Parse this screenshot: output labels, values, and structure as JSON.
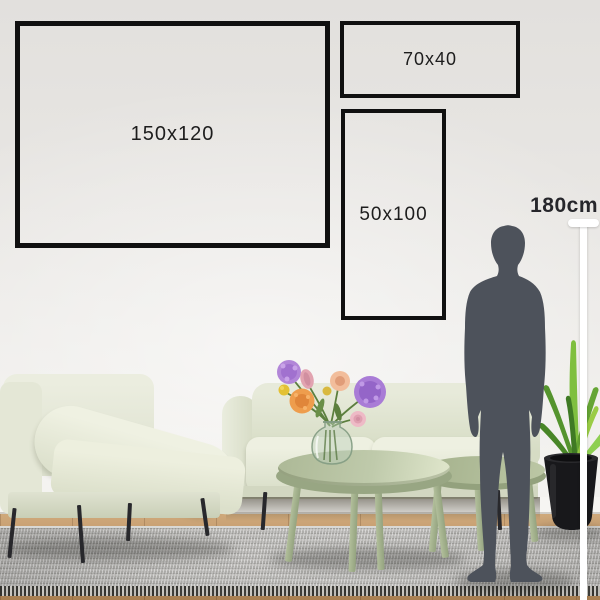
{
  "scene": {
    "description": "Wall art size guide: three frame outlines above a living room scene with a human silhouette for scale"
  },
  "frames": [
    {
      "label": "150x120"
    },
    {
      "label": "70x40"
    },
    {
      "label": "50x100"
    }
  ],
  "height_reference": {
    "label": "180cm"
  },
  "colors": {
    "frame_border": "#101010",
    "wall": "#e9e7e4",
    "sofa_sage": "#e3e7d4",
    "table_sage": "#b3bf9e",
    "rug_gray": "#aaa9a6",
    "floor_wood": "#bb9165",
    "silhouette": "#4d525b",
    "measure_line": "#ffffff",
    "plant_green": "#6fae35",
    "pot_black": "#18181b",
    "flower_purple": "#a97cd6",
    "flower_orange": "#ee9d4d",
    "flower_pink": "#e7aab6",
    "flower_yellow": "#e5c334"
  }
}
